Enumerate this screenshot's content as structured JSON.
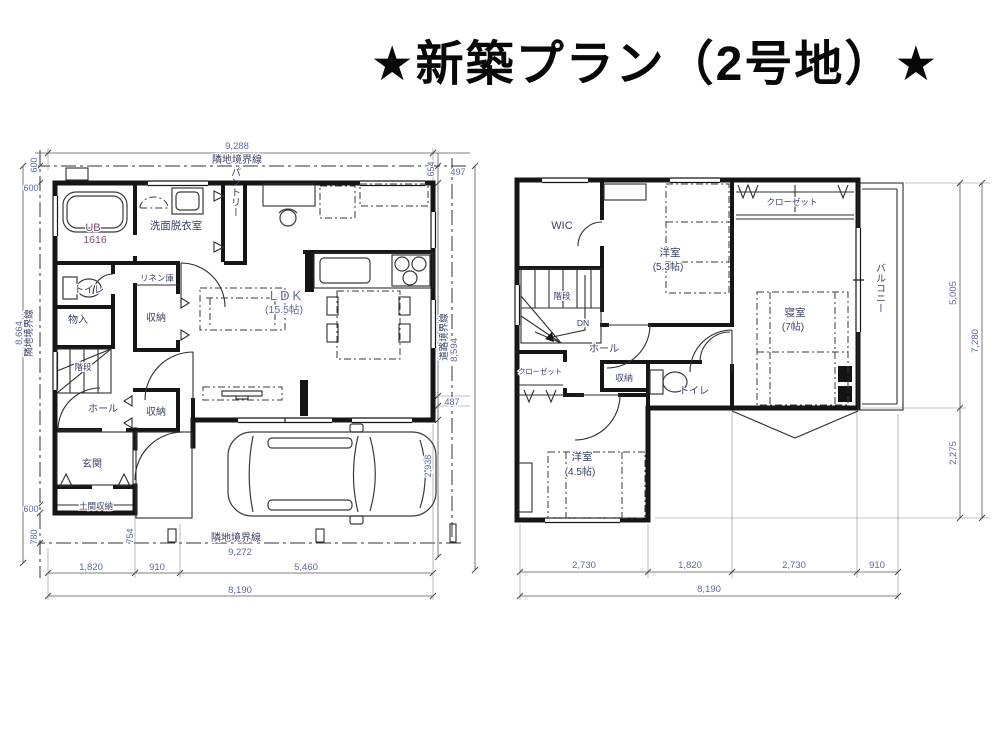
{
  "title": "★新築プラン（2号地）★",
  "colors": {
    "wall": "#161616",
    "label": "#394266",
    "dimension": "#5c68a2",
    "ub_text": "#7c5172",
    "background": "#ffffff"
  },
  "floor1": {
    "rooms": {
      "ub": "UB",
      "ub_size": "1616",
      "senmen": "洗面脱衣室",
      "pantry": "パントリー",
      "linen": "リネン庫",
      "toilet": "トイレ",
      "monoire": "物入",
      "stairs": "階段",
      "closet_mid": "収納",
      "closet_low": "収納",
      "hall": "ホール",
      "genkan": "玄関",
      "doma": "土間収納",
      "ldk": "LDK",
      "ldk_size": "(15.5帖)"
    },
    "bound": {
      "top": "隣地境界線",
      "left": "隣地境界線",
      "bottom": "隣地境界線",
      "right": "道路境界線"
    },
    "dims": {
      "top_total": "9,288",
      "r654": "654",
      "r497": "497",
      "r8594": "8,594",
      "r487": "487",
      "r2938": "2,938",
      "l600a": "600",
      "l600b": "600",
      "l8664": "8,664",
      "l600c": "600",
      "l780": "780",
      "b754": "754",
      "b9272": "9,272",
      "b1820": "1,820",
      "b910": "910",
      "b5460": "5,460",
      "b8190": "8,190"
    }
  },
  "floor2": {
    "rooms": {
      "wic": "WIC",
      "yoshitsu53": "洋室",
      "yoshitsu53_size": "(5.3帖)",
      "closet_top": "クローゼット",
      "shinshitsu": "寝室",
      "shinshitsu_size": "(7帖)",
      "balcony": "バルコニー",
      "stairs": "階段",
      "dn": "DN",
      "hall": "ホール",
      "closet_left": "クローゼット",
      "shuno": "収納",
      "toilet": "トイレ",
      "yoshitsu45": "洋室",
      "yoshitsu45_size": "(4.5帖)"
    },
    "dims": {
      "r5005": "5,005",
      "r7280": "7,280",
      "r2275": "2,275",
      "b2730a": "2,730",
      "b1820": "1,820",
      "b2730b": "2,730",
      "b910": "910",
      "b8190": "8,190"
    }
  }
}
